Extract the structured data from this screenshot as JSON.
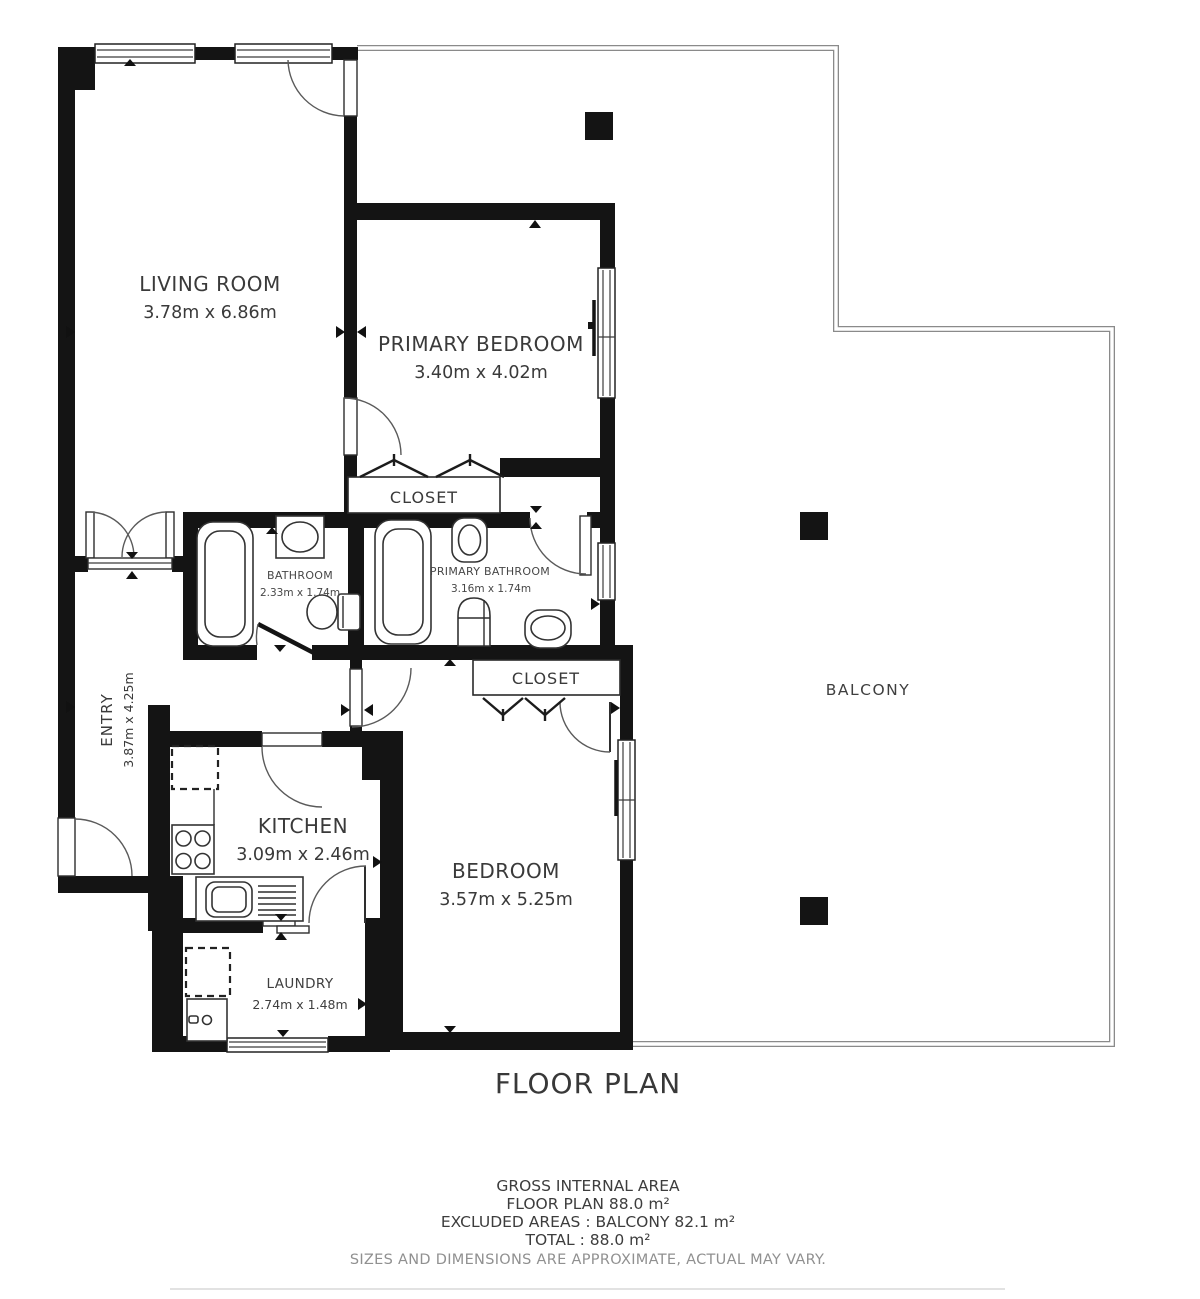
{
  "plan": {
    "title": "FLOOR PLAN",
    "rooms": {
      "living_room": {
        "name": "LIVING ROOM",
        "dims": "3.78m x 6.86m"
      },
      "primary_bedroom": {
        "name": "PRIMARY BEDROOM",
        "dims": "3.40m x 4.02m"
      },
      "closet_primary": {
        "name": "CLOSET"
      },
      "bathroom": {
        "name": "BATHROOM",
        "dims": "2.33m x 1.74m"
      },
      "primary_bathroom": {
        "name": "PRIMARY BATHROOM",
        "dims": "3.16m x 1.74m"
      },
      "closet_bedroom": {
        "name": "CLOSET"
      },
      "entry": {
        "name": "ENTRY",
        "dims": "3.87m x 4.25m"
      },
      "kitchen": {
        "name": "KITCHEN",
        "dims": "3.09m x 2.46m"
      },
      "bedroom": {
        "name": "BEDROOM",
        "dims": "3.57m x 5.25m"
      },
      "laundry": {
        "name": "LAUNDRY",
        "dims": "2.74m x 1.48m"
      },
      "balcony": {
        "name": "BALCONY"
      }
    },
    "summary": {
      "line1": "GROSS INTERNAL AREA",
      "line2": "FLOOR PLAN 88.0 m²",
      "line3": "EXCLUDED AREAS :  BALCONY 82.1 m²",
      "line4": "TOTAL :  88.0 m²",
      "disclaimer": "SIZES AND DIMENSIONS ARE APPROXIMATE, ACTUAL MAY VARY."
    },
    "colors": {
      "wall": "#141414",
      "text": "#3a3a3a",
      "muted": "#909090",
      "rail": "#8a8a8a"
    }
  }
}
